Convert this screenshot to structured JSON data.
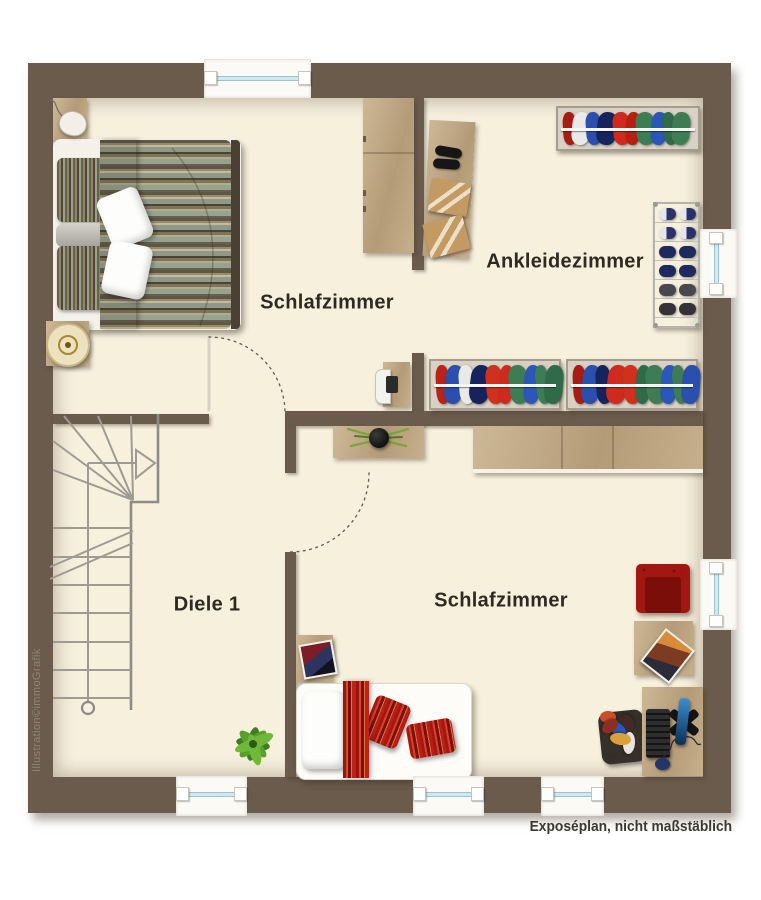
{
  "rooms": {
    "bedroom_top": {
      "label": "Schlafzimmer"
    },
    "dressing_room": {
      "label": "Ankleidezimmer"
    },
    "hallway": {
      "label": "Diele 1"
    },
    "bedroom_bottom": {
      "label": "Schlafzimmer"
    }
  },
  "footer": {
    "disclaimer": "Exposéplan, nicht maßstäblich"
  },
  "watermark": {
    "credit": "Illustration©immoGrafik"
  },
  "palette": {
    "wall": "#6a5b4d",
    "floor": "#f7f0dd",
    "wood": "#c3ab88",
    "stair_line": "#9d9b94",
    "window_glass": "#cfe9f2",
    "label_text": "#2d2a24",
    "accent_red": "#b5211a"
  },
  "racks": {
    "top": [
      "#a81d13",
      "#e9e9e7",
      "#2b4fae",
      "#16245e",
      "#cf2a1d",
      "#b5200f",
      "#3e7d54",
      "#2b58b8",
      "#2f6b49",
      "#3e7d54"
    ],
    "bottom_left": [
      "#b92318",
      "#2b4fae",
      "#e9e9e7",
      "#16245e",
      "#d0311c",
      "#cf2a1d",
      "#3e7d54",
      "#2b58b8",
      "#3e7d54",
      "#2f6b49"
    ],
    "bottom_right": [
      "#a81d13",
      "#2b4fae",
      "#16245e",
      "#cf2a1d",
      "#d0311c",
      "#2f6b49",
      "#3e7d54",
      "#2b58b8",
      "#3e7d54",
      "#2b4fae"
    ]
  },
  "shoe_rack": {
    "rows": [
      "linear-gradient(90deg,#e5e6ea 45%,#28336e 45%)",
      "linear-gradient(90deg,#e5e6ea 45%,#28336e 45%)",
      "#1e2a5e",
      "#1e2a5e",
      "#47474d",
      "#333339"
    ]
  },
  "clothes_pile": [
    "#c94f2a",
    "#2b58b8",
    "#e8e4da",
    "#8c2f23",
    "#d9a13a",
    "#44282a"
  ]
}
